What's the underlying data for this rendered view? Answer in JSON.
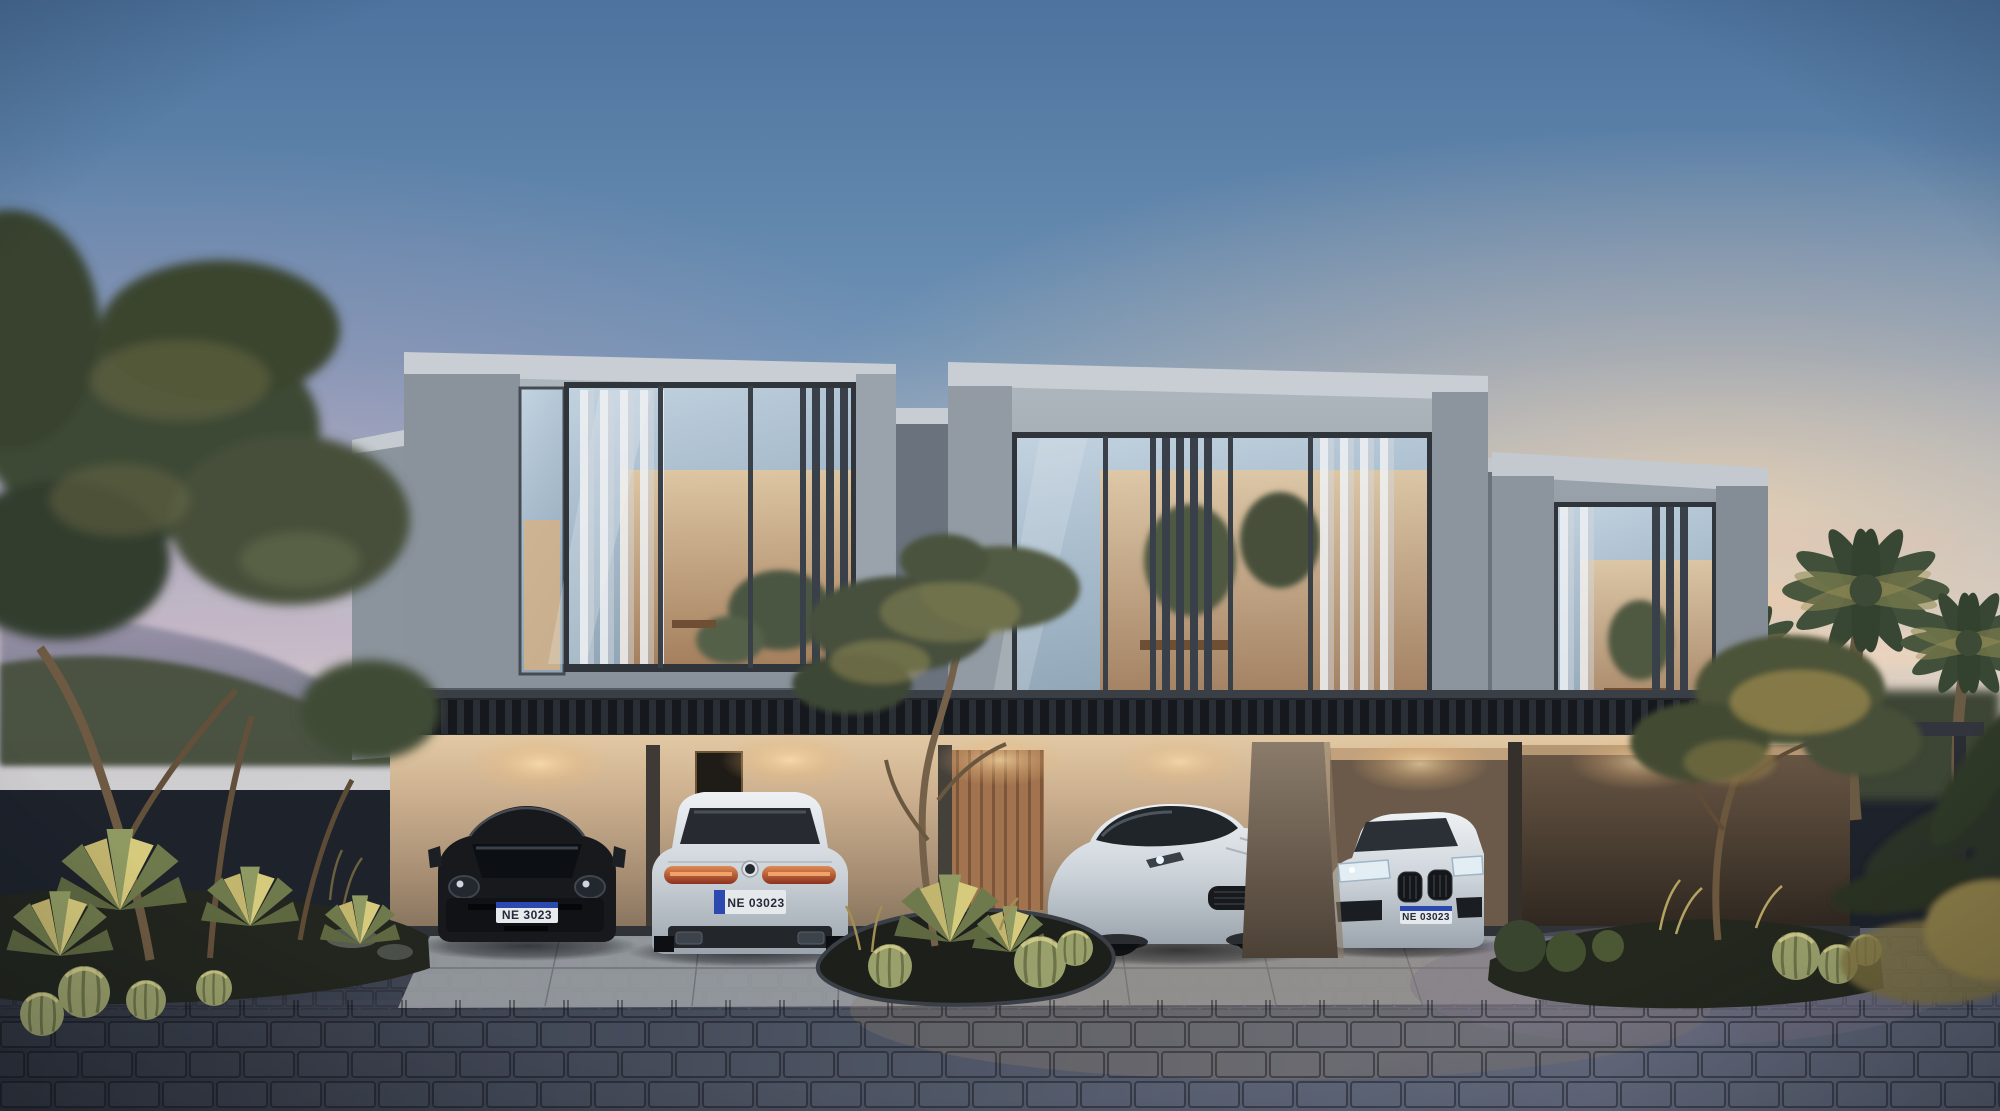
{
  "scene": {
    "kind": "photorealistic architectural rendering",
    "setting": "modern two-storey townhouse row at dusk with four luxury cars parked in lit carports",
    "time_of_day": "dusk",
    "lighting": "warm soffit and interior lighting against a cool blue evening sky"
  },
  "building": {
    "storeys": 2,
    "upper_volumes": 3,
    "car_bays": 4,
    "materials": [
      "gray concrete panels",
      "floor-to-ceiling glazing",
      "dark vertical louvers",
      "sheer white curtains",
      "warm beige lower walls",
      "timber entry door"
    ]
  },
  "cars": {
    "porsche": {
      "label": "black sports coupe, front view",
      "plate": "NE 3023"
    },
    "bmw_rear": {
      "label": "white luxury coupe, rear view",
      "plate": "NE 03023"
    },
    "ferrari": {
      "label": "silver grand tourer, three-quarter front view"
    },
    "bmw_front": {
      "label": "white luxury coupe, front view",
      "plate": "NE 03023"
    }
  },
  "landscape": {
    "left": "olive trees, agaves, barrel cacti in dark planting bed",
    "center": "lit desert planting island with olive tree, agave and barrel cacti",
    "right": "olive tree bed with grasses and cacti, date palms behind",
    "foreground": "dark blue-gray cobblestone driveway with light concrete apron"
  },
  "palette": {
    "sky_top": "#4d739e",
    "sky_horizon_warm": "#f2d4ae",
    "sky_horizon_pink": "#c29cb4",
    "upper_facade": "#9aa3ac",
    "lower_wall_lit": "#d9bd97",
    "soffit": "#23262c",
    "louver": "#3a4049",
    "glass": "#a9bdcd",
    "interior_glow": "#d8b488",
    "pavement": "#4e5565",
    "vegetation": "#47503c",
    "plate_blue": "#2b49ae"
  }
}
